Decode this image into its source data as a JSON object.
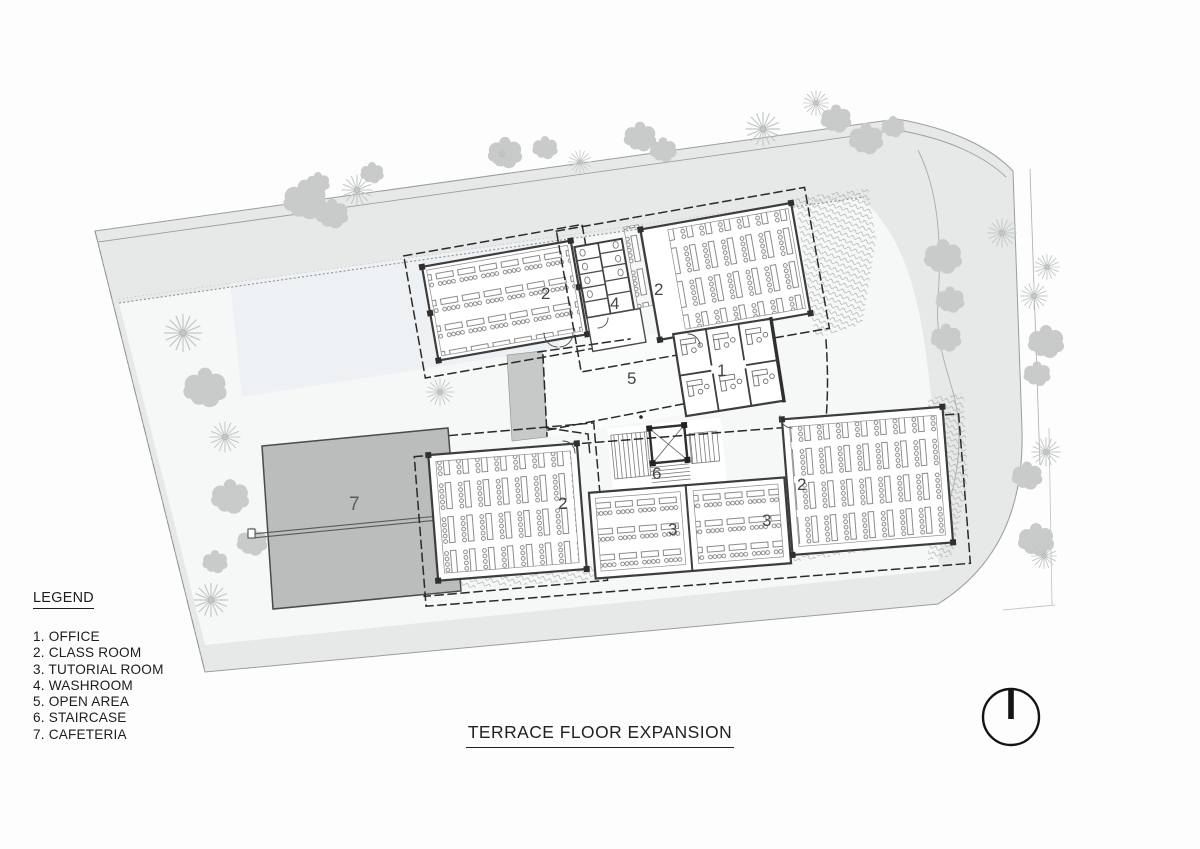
{
  "title": {
    "text": "TERRACE FLOOR EXPANSION"
  },
  "legend": {
    "heading": "LEGEND",
    "items": [
      "1. OFFICE",
      "2. CLASS ROOM",
      "3. TUTORIAL ROOM",
      "4. WASHROOM",
      "5. OPEN AREA",
      "6. STAIRCASE",
      "7. CAFETERIA"
    ]
  },
  "plan": {
    "room_labels": {
      "office": "1",
      "classroom": "2",
      "tutorial": "3",
      "washroom": "4",
      "open_area": "5",
      "staircase": "6",
      "cafeteria": "7"
    }
  },
  "icons": {
    "north_arrow": "north-arrow"
  },
  "colors": {
    "site_gray": "#e7e9e9",
    "interior_light": "#f6f8f8",
    "pond_tint": "#eef1f3",
    "cafeteria_gray": "#babdbc",
    "walkway_gray": "#c6c9c8",
    "wall_dark": "#3d3d3d",
    "line_ink": "#232021"
  }
}
